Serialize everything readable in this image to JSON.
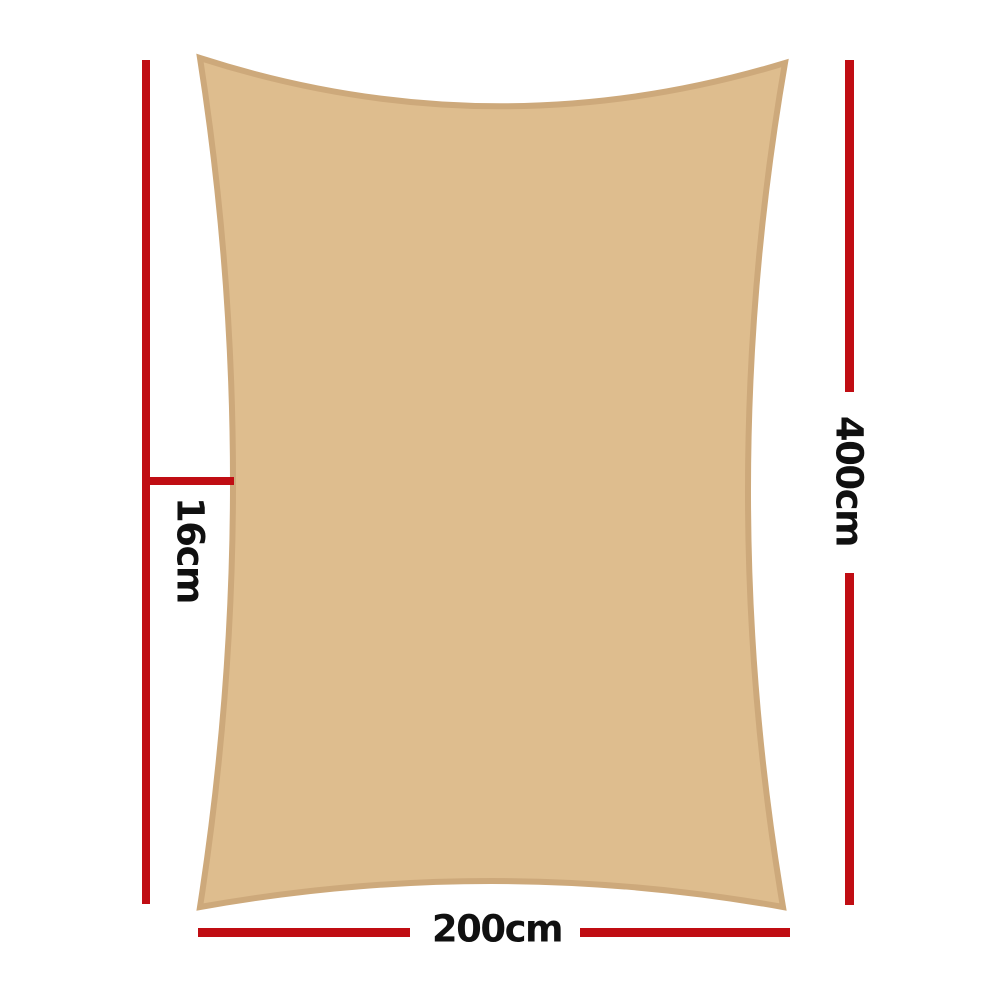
{
  "colors": {
    "accent-red": "#c00d13",
    "sail-fill": "#debd8e",
    "sail-border": "#cda97b",
    "label": "#101010",
    "background": "#ffffff"
  },
  "labels": {
    "width": "200cm",
    "height": "400cm",
    "side": "16cm"
  }
}
